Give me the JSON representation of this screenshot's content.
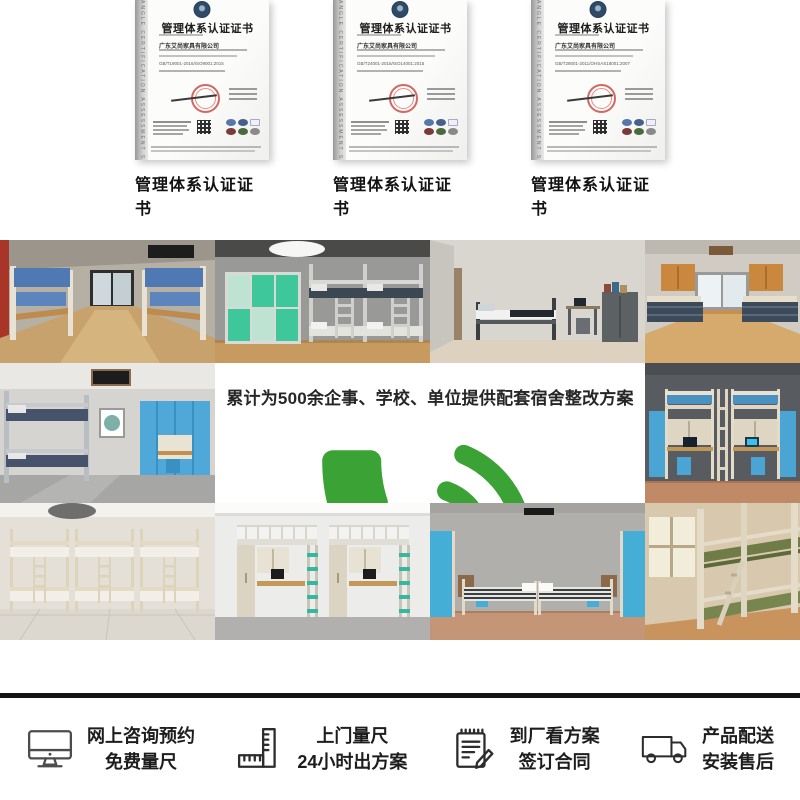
{
  "brand": {
    "monogram": "AS",
    "name": "艾尚家具",
    "orange": "#ED7D1E",
    "green": "#3BA335"
  },
  "certificates": {
    "side_text": "ANGLE CERTIFICATION ASSESSMENT SERVICES",
    "items": [
      {
        "title": "管理体系认证证书",
        "company": "广东艾尚家具有限公司",
        "standard": "GB/T19001-2016/ISO9001:2015",
        "caption": "管理体系认证证书"
      },
      {
        "title": "管理体系认证证书",
        "company": "广东艾尚家具有限公司",
        "standard": "GB/T24001-2016/ISO14001:2015",
        "caption": "管理体系认证证书"
      },
      {
        "title": "管理体系认证证书",
        "company": "广东艾尚家具有限公司",
        "standard": "GB/T28001-2011/OHSAS18001:2007",
        "caption": "管理体系认证证书"
      }
    ]
  },
  "banner": {
    "headline": "累计为500余企事、学校、单位提供配套宿舍整改方案",
    "hotline_label": "全国订购服务热线",
    "phone": "400-0099-515",
    "phone_icon": "phone-icon"
  },
  "services": {
    "items": [
      {
        "icon": "monitor-icon",
        "line1": "网上咨询预约",
        "line2": "免费量尺"
      },
      {
        "icon": "ruler-icon",
        "line1": "上门量尺",
        "line2": "24小时出方案"
      },
      {
        "icon": "contract-icon",
        "line1": "到厂看方案",
        "line2": "签订合同"
      },
      {
        "icon": "truck-icon",
        "line1": "产品配送",
        "line2": "安装售后"
      }
    ]
  }
}
